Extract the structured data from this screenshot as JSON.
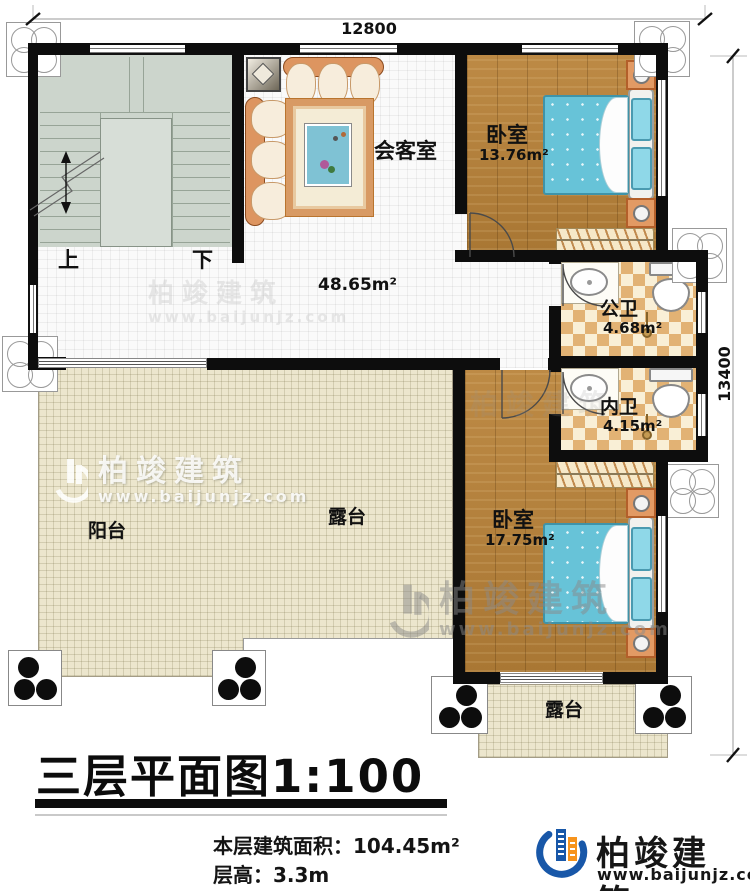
{
  "plan": {
    "dimensions": {
      "width": "12800",
      "height": "13400"
    },
    "stairs": {
      "up_label": "上",
      "down_label": "下"
    },
    "rooms": {
      "meeting": {
        "label": "会客室"
      },
      "hall": {
        "area": "48.65m²"
      },
      "bedroom_top": {
        "label": "卧室",
        "area": "13.76m²"
      },
      "bedroom_bottom": {
        "label": "卧室",
        "area": "17.75m²"
      },
      "bath_public": {
        "label": "公卫",
        "area": "4.68m²"
      },
      "bath_private": {
        "label": "内卫",
        "area": "4.15m²"
      },
      "balcony": {
        "label": "阳台"
      },
      "terrace": {
        "label": "露台"
      }
    }
  },
  "footer": {
    "title": "三层平面图1:100",
    "building_area": "本层建筑面积：104.45m²",
    "floor_height": "层高：3.3m"
  },
  "brand": {
    "name": "柏竣建筑",
    "website": "www.baijunjz.com",
    "blue": "#1857a8",
    "orange": "#f7941d"
  },
  "watermark": {
    "name": "柏竣建筑",
    "website": "www.baijunjz.com"
  }
}
